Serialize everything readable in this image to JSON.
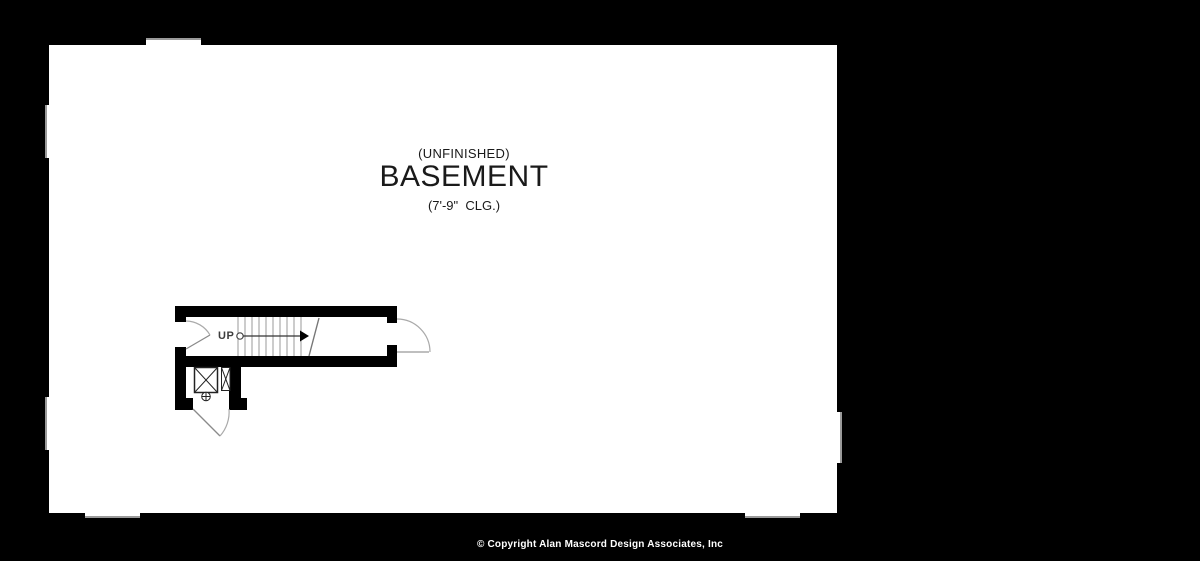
{
  "window": {
    "width": 1200,
    "height": 561
  },
  "colors": {
    "background": "#000000",
    "paper": "#ffffff",
    "wall_line": "#000000",
    "detail_line": "#999999",
    "label_text": "#1a1a1a",
    "footer_text": "#ffffff"
  },
  "floorplan": {
    "room": {
      "status_label": "(UNFINISHED)",
      "name_label": "BASEMENT",
      "ceiling_label": "(7'-9\"  CLG.)"
    },
    "stair": {
      "direction_label": "UP"
    }
  },
  "footer": {
    "copyright": "© Copyright Alan Mascord Design Associates, Inc"
  }
}
